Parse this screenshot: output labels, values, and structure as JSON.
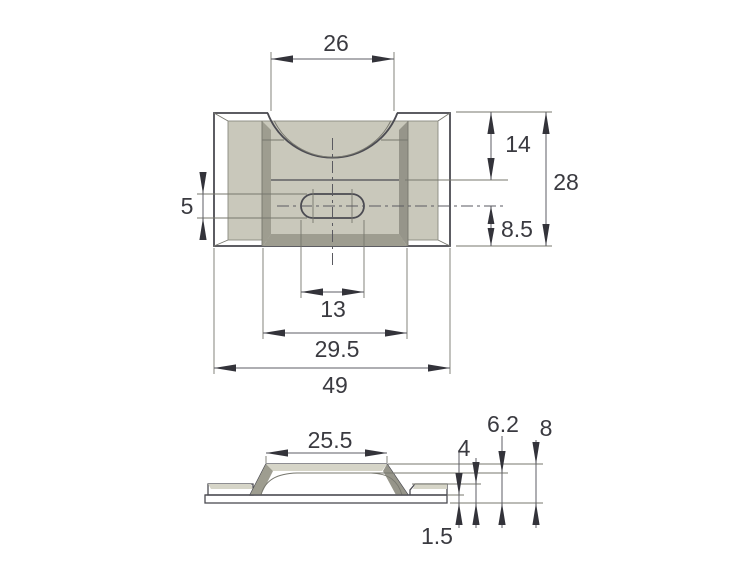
{
  "document": {
    "type": "engineering-dimension-drawing",
    "part": "saddle clamp bracket",
    "units_shown": "mm (implied, unlabeled)"
  },
  "colors": {
    "background": "#ffffff",
    "face": "#c9c8bb",
    "bevel": "#b5b4a7",
    "slope": "#9e9d90",
    "slope_dark": "#96958a",
    "top_face": "#d6d5c8",
    "dome": "#c2c1b4",
    "hole_white": "#ffffff",
    "outline": "#4b4b52",
    "dim_line": "#5d5d64",
    "text": "#3a3a40"
  },
  "views": {
    "top": {
      "label": "top-view",
      "dimensions": {
        "cutout_width": "26",
        "saddle_depth": "14",
        "total_depth": "28",
        "slot_height": "5",
        "slot_center_to_bottom": "8.5",
        "slot_length": "13",
        "recess_width": "29.5",
        "total_width": "49"
      }
    },
    "side": {
      "label": "side-view",
      "dimensions": {
        "boss_top_width": "25.5",
        "saddle_height": "6.2",
        "total_height": "8",
        "flange_height": "4",
        "base_lip_thickness": "1.5"
      }
    }
  }
}
